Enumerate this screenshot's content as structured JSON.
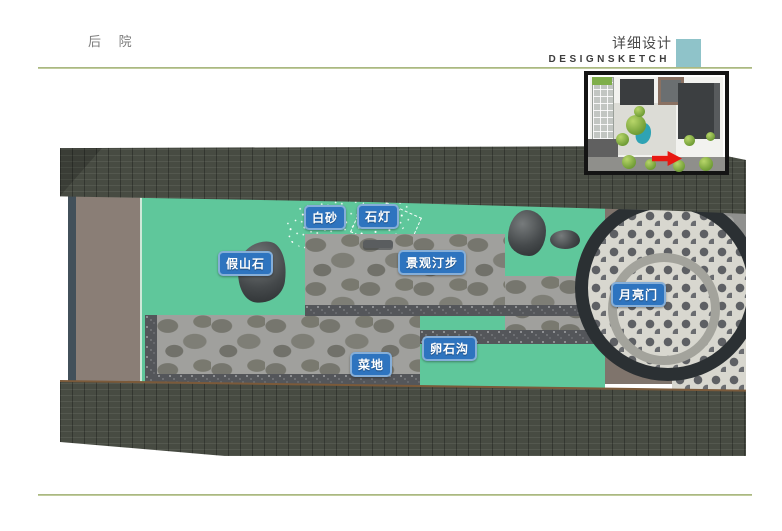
{
  "header": {
    "section_title": "后 院",
    "title_cn": "详细设计",
    "title_en": "DESIGNSKETCH"
  },
  "plan_labels": [
    {
      "text": "白砂"
    },
    {
      "text": "石灯"
    },
    {
      "text": "假山石"
    },
    {
      "text": "景观汀步"
    },
    {
      "text": "月亮门"
    },
    {
      "text": "卵石沟"
    },
    {
      "text": "菜地"
    }
  ],
  "colors": {
    "accent_teal": "#8fc3c9",
    "rule_olive": "#a9b97f",
    "label_blue": "#2e74bf",
    "label_border": "#85aed8",
    "lawn_green": "#5fc79b",
    "roof_gray": "#474b42",
    "wall_taupe": "#8a7e76",
    "stone_gray": "#a0a09d",
    "pebble_dark": "#54565a",
    "arrow_red": "#e81811"
  }
}
